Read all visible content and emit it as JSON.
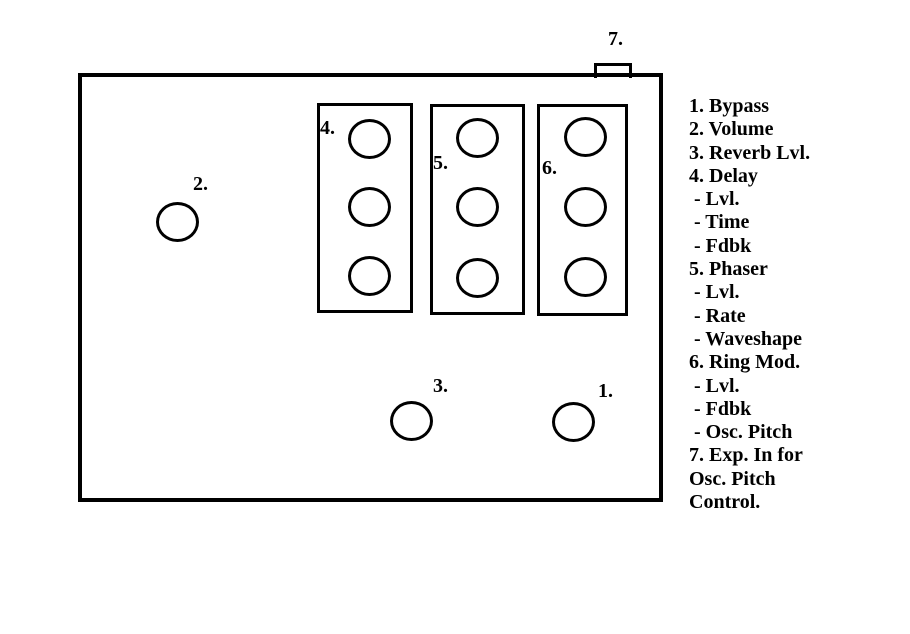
{
  "colors": {
    "background": "#ffffff",
    "stroke": "#000000"
  },
  "pedal": {
    "labels": {
      "bypass": "1.",
      "volume": "2.",
      "reverb": "3.",
      "delay": "4.",
      "phaser": "5.",
      "ringmod": "6.",
      "exp_jack": "7."
    }
  },
  "legend": {
    "lines": [
      "1. Bypass",
      "2. Volume",
      "3. Reverb Lvl.",
      "4. Delay",
      " - Lvl.",
      " - Time",
      " - Fdbk",
      "5. Phaser",
      " - Lvl.",
      " - Rate",
      " - Waveshape",
      "6. Ring Mod.",
      " - Lvl.",
      " - Fdbk",
      " - Osc. Pitch",
      "7. Exp. In for",
      "Osc. Pitch",
      "Control."
    ]
  }
}
